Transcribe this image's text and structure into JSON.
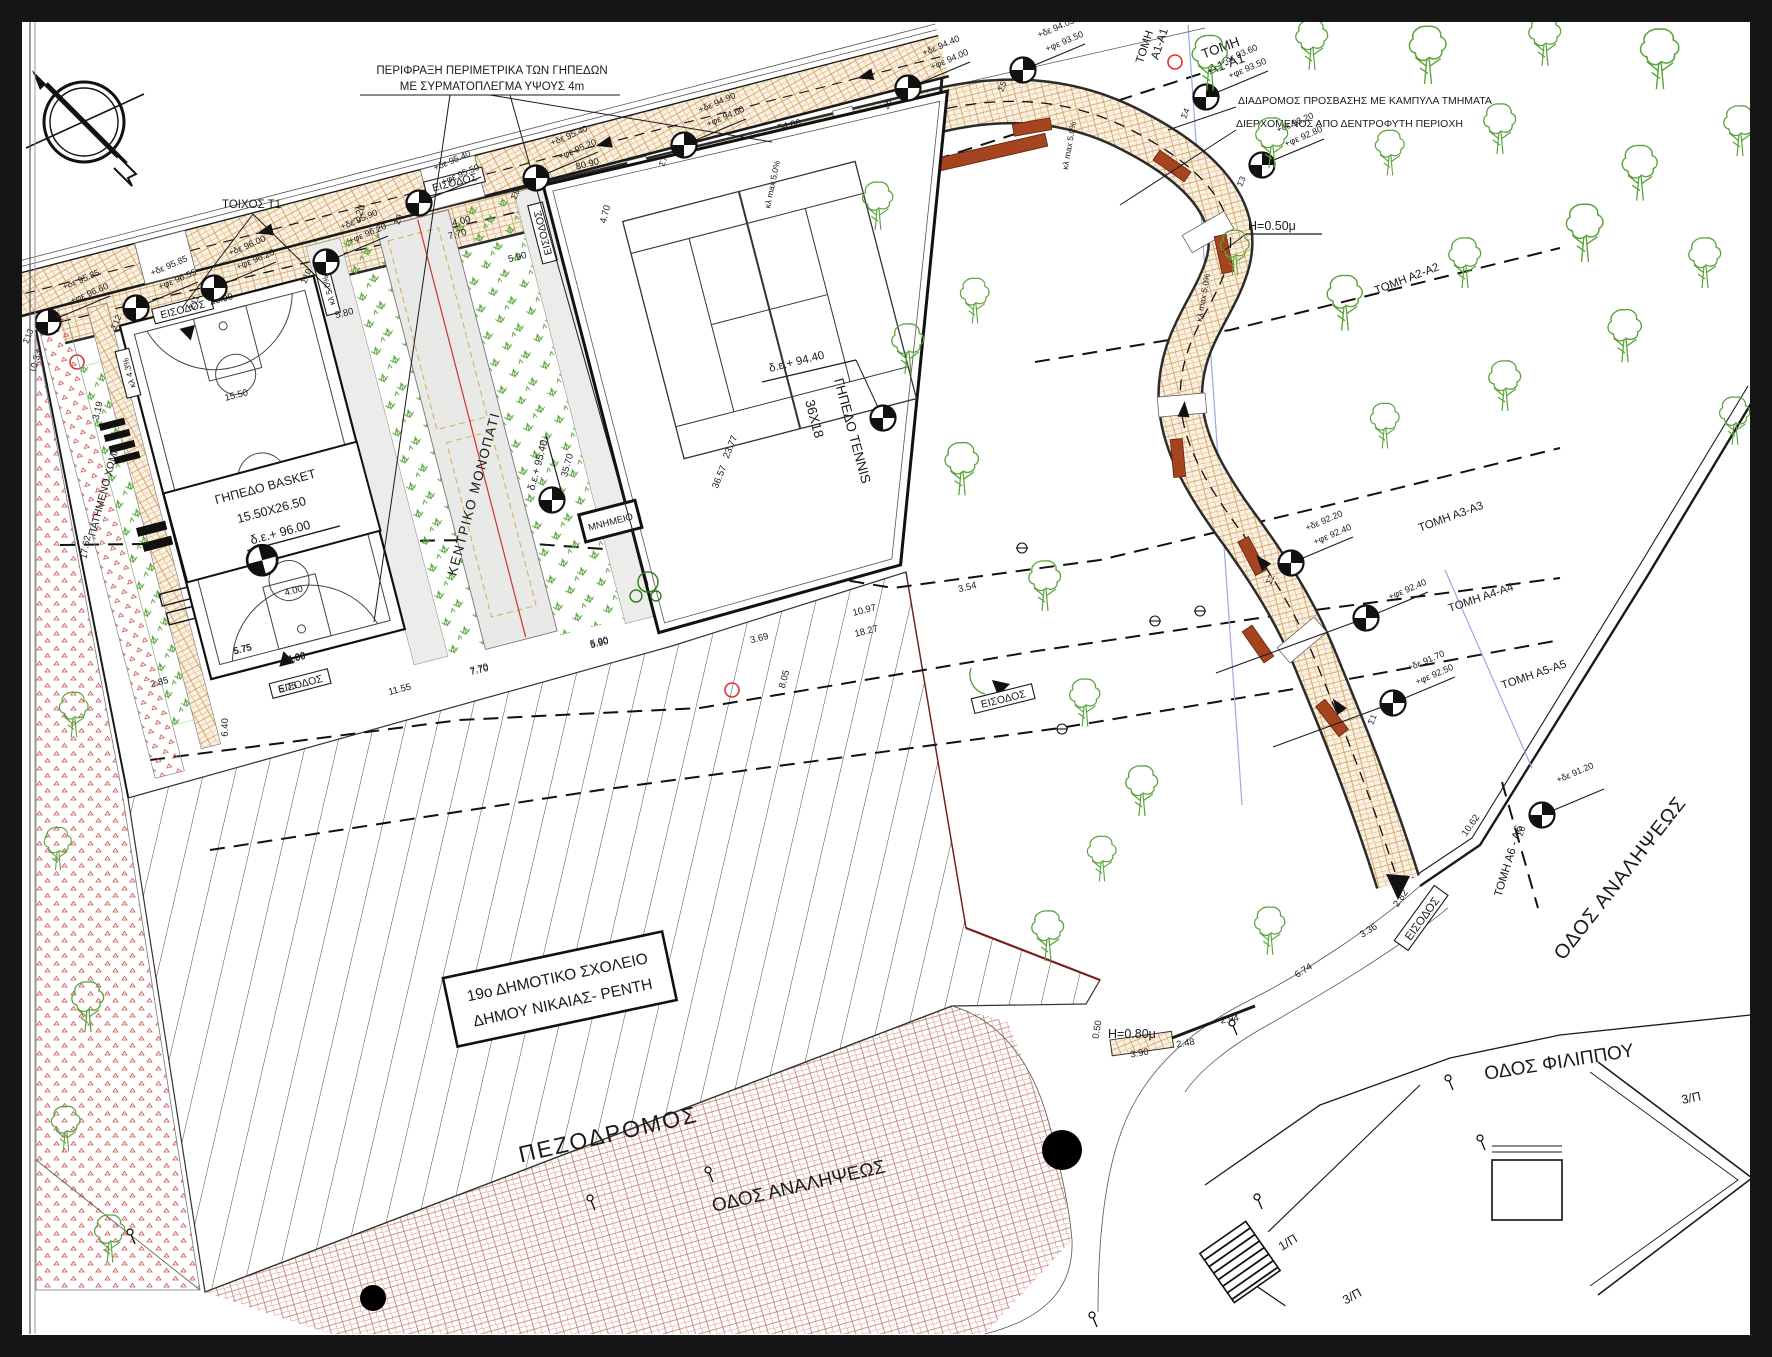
{
  "notes": {
    "fence1": "ΠΕΡΙΦΡΑΞΗ ΠΕΡΙΜΕΤΡΙΚΑ ΤΩΝ ΓΗΠΕΔΩΝ",
    "fence2": "ΜΕ ΣΥΡΜΑΤΟΠΛΕΓΜΑ ΥΨΟΥΣ 4m",
    "access1": "ΔΙΑΔΡΟΜΟΣ ΠΡΟΣΒΑΣΗΣ  ΜΕ ΚΑΜΠΥΛΑ ΤΜΗΜΑΤΑ",
    "access2": "ΔΙΕΡΧΟΜΕΝΟΣ ΑΠΟ ΔΕΝΤΡΟΦΥΤΗ ΠΕΡΙΟΧΗ"
  },
  "walls": {
    "t1": "ΤΟΙΧΟΣ Τ1",
    "t5": "ΟΣ Τ5",
    "h050": "H=0.50μ",
    "h080": "H=0.80μ"
  },
  "entrance": "ΕΙΣΟΔΟΣ",
  "areas": {
    "basket_title": "ΓΗΠΕΔΟ BASKET",
    "basket_size": "15.50X26.50",
    "basket_elev": "δ.ε.+ 96.00",
    "tennis_title": "ΓΗΠΕΔΟ TENNIS",
    "tennis_size": "36Χ18",
    "tennis_elev": "δ.ε.+ 94.40",
    "path_title": "ΚΕΝΤΡΙΚΟ ΜΟΝΟΠΑΤΙ",
    "path_elev": "δ.ε.+ 95.40",
    "monument": "ΜΝΗΜΕΙΟ",
    "soil": "ΠΑΤΗΜΕΝΟ ΧΩΜΑ",
    "hill_frag": "ΦΟΣ"
  },
  "school": {
    "line1": "19ο ΔΗΜΟΤΙΚΟ ΣΧΟΛΕΙΟ",
    "line2": "ΔΗΜΟΥ ΝΙΚΑΙΑΣ- ΡΕΝΤΗ"
  },
  "streets": {
    "ped": "ΠΕΖΟΔΡΟΜΟΣ",
    "analipseos": "ΟΔΟΣ ΑΝΑΛΗΨΕΩΣ",
    "filippou": "ΟΔΟΣ ΦΙΛΙΠΠΟΥ"
  },
  "sections": {
    "tomi": "ΤΟΜΗ",
    "a1": "A1-A1",
    "a2": "ΤΟΜΗ Α2-Α2",
    "a3": "ΤΟΜΗ Α3-Α3",
    "a4": "ΤΟΜΗ Α4-Α4",
    "a5": "ΤΟΜΗ Α5-Α5",
    "a6": "ΤΟΜΗ Α6 - Α6"
  },
  "slopes": {
    "k43": "κλ 4.3%",
    "k50": "κλ 5.0%",
    "kmax": "κλ max 5.0%"
  },
  "plans": {
    "p1": "1/Π",
    "p3": "3/Π"
  },
  "markers": [
    {
      "s": "Σ13",
      "de": "+δε 95.85",
      "fe": "+φε 96.60"
    },
    {
      "s": "Σ12",
      "de": "+δε 95.85",
      "fe": "+φε 96.55"
    },
    {
      "s": "Σ11",
      "de": "+δε 96.00",
      "fe": "+φε 96.20"
    },
    {
      "s": "Σ10",
      "de": "+δε 95.90",
      "fe": "+φε 96.20"
    },
    {
      "s": "Σ9",
      "de": "+δε 95.40",
      "fe": "+φε 95.50"
    },
    {
      "s": "Σ8",
      "de": "+δε 95.40",
      "fe": "+φε 95.20"
    },
    {
      "s": "Σ7",
      "de": "+δε 94.90",
      "fe": "+φε 94.60"
    },
    {
      "s": "Σ6",
      "de": "+δε 94.40",
      "fe": "+φε 94.00"
    },
    {
      "s": "Σ5",
      "de": "+δε 94.05",
      "fe": "+φε 93.50"
    },
    {
      "s": "Σ4",
      "de": "+δε 93.60",
      "fe": "+φε 93.50"
    },
    {
      "s": "Σ3",
      "de": "+δε 93.20",
      "fe": "+φε 92.80"
    },
    {
      "s": "Σ2",
      "de": "+δε 92.20",
      "fe": "+φε 92.40"
    },
    {
      "s": "",
      "de": "",
      "fe": "+φε 92.40"
    },
    {
      "s": "Σ1",
      "de": "+δε 91.70",
      "fe": "+φε 92.50"
    },
    {
      "s": "Σ0",
      "de": "+δε 91.20",
      "fe": ""
    }
  ],
  "dims": {
    "k5400": "54.00",
    "k8090": "80.90",
    "k2690": "26.90",
    "k1550": "15.50",
    "k580": "5.80",
    "k590": "5.90",
    "k2377": "23.77",
    "k3657": "36.57",
    "k3570": "35.70",
    "k354": "3.54",
    "k1097": "10.97",
    "k1827": "18.27",
    "k369": "3.69",
    "k805": "8.05",
    "k770": "7.70",
    "k1155": "11.55",
    "k575": "5.75",
    "k400": "4.00",
    "k285": "2.85",
    "k640": "6.40",
    "k220": "2.20",
    "k470": "4.70",
    "k1062": "10.62",
    "k674": "6.74",
    "k336": "3.36",
    "k282": "2.82",
    "k390": "3.90",
    "k248": "2.48",
    "k294": "2.94",
    "k050": "0.50",
    "k1033": "10.33",
    "k319": "3.19",
    "k1762": "17.62"
  },
  "colors": {
    "brick": "#cf9a55",
    "brick_red": "#c4766a",
    "green": "#58a33a",
    "bench": "#a5441f",
    "section_red": "#7a1f1f",
    "path_label": "#c8960c",
    "blue_line": "#99a8e8"
  }
}
